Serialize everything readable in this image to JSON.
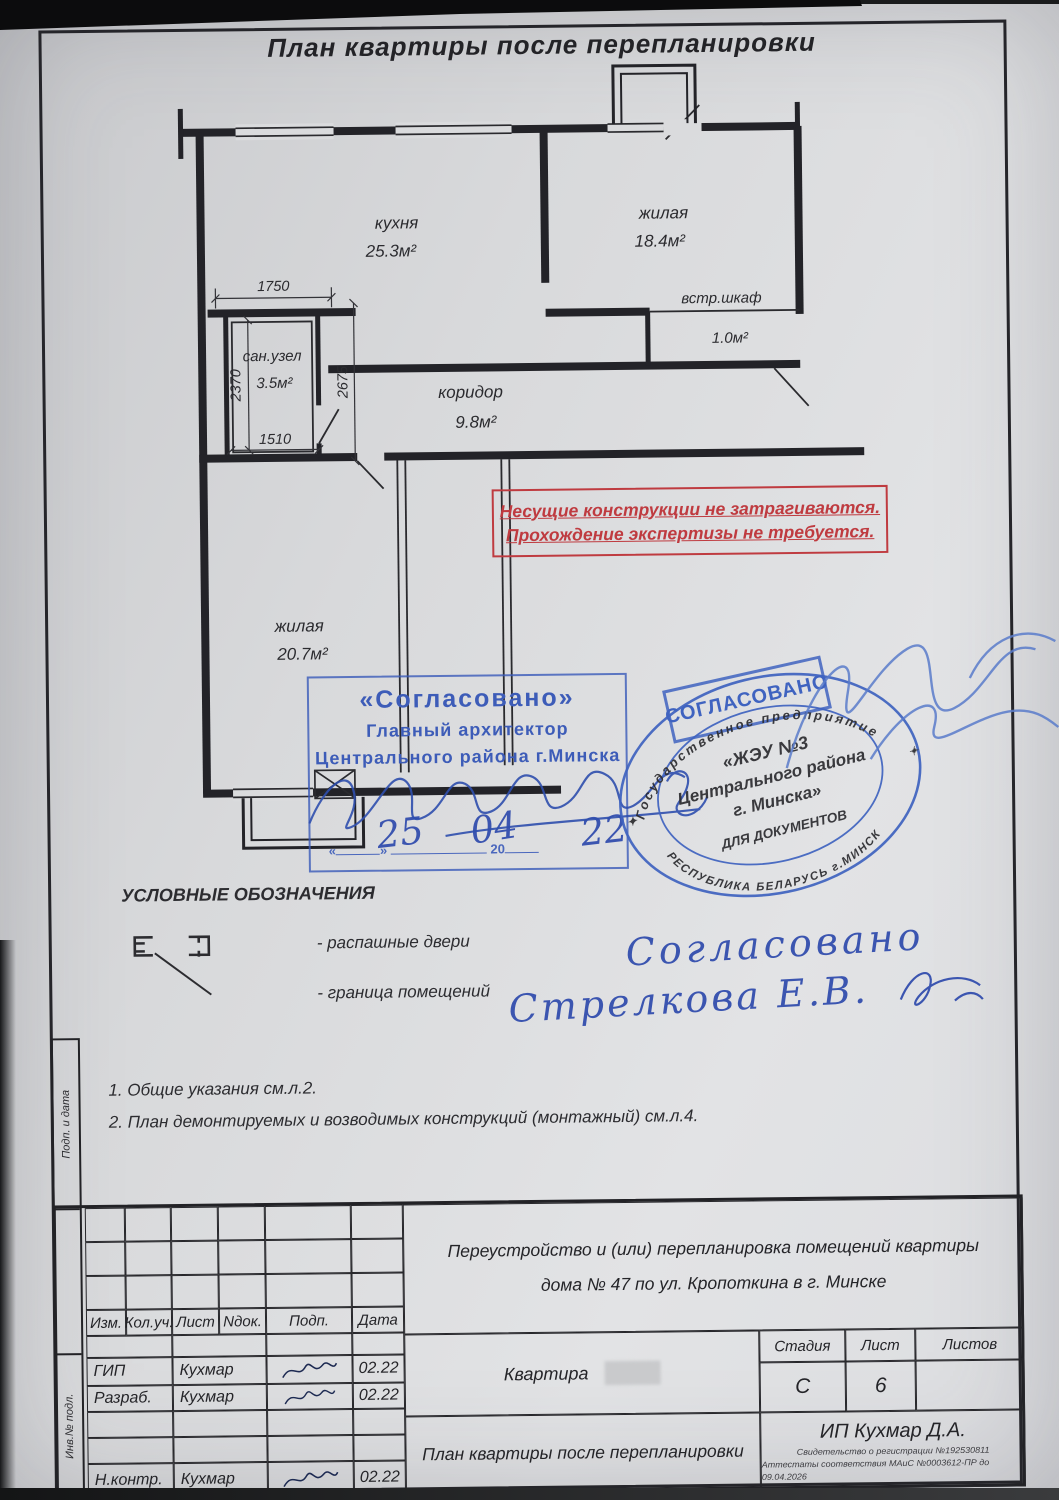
{
  "page_title": "План квартиры после перепланировки",
  "plan": {
    "rooms": {
      "kitchen": {
        "name": "кухня",
        "area": "25.3м²"
      },
      "living1": {
        "name": "жилая",
        "area": "18.4м²"
      },
      "closet": {
        "name": "встр.шкаф",
        "area": "1.0м²"
      },
      "corridor": {
        "name": "коридор",
        "area": "9.8м²"
      },
      "bathroom": {
        "name": "сан.узел",
        "area": "3.5м²"
      },
      "living2": {
        "name": "жилая",
        "area": "20.7м²"
      }
    },
    "dimensions": {
      "d1750": "1750",
      "d2370": "2370",
      "d1510": "1510",
      "d2675": "2675"
    }
  },
  "red_stamp": {
    "line1": "Несущие конструкции не затрагиваются.",
    "line2": "Прохождение экспертизы не требуется.",
    "color": "#bf3b40"
  },
  "approval_stamp": {
    "title": "«Согласовано»",
    "line1": "Главный архитектор",
    "line2": "Центрального района г.Минска",
    "quote_open": "«",
    "quote_close": "»",
    "year_prefix": "20",
    "date_day": "25",
    "date_month": "04",
    "date_year": "22",
    "color": "#3d5cb8"
  },
  "round_stamp": {
    "banner": "СОГЛАСОВАНО",
    "arc_top": "Государственное предприятие",
    "center_line1": "«ЖЭУ №3",
    "center_line2": "Центрального района",
    "center_line3": "г. Минска»",
    "center_line4": "ДЛЯ ДОКУМЕНТОВ",
    "arc_bottom": "РЕСПУБЛИКА БЕЛАРУСЬ г.МИНСК",
    "star": "✦",
    "color": "#3f63c0"
  },
  "handwriting": {
    "word1": "Согласовано",
    "word2": "Стрелкова Е.В.",
    "color": "#3b55b0"
  },
  "legend": {
    "title": "УСЛОВНЫЕ ОБОЗНАЧЕНИЯ",
    "item1": "- распашные двери",
    "item2": "- граница помещений"
  },
  "notes": {
    "n1": "1. Общие указания см.л.2.",
    "n2": "2. План демонтируемых и возводимых конструкций (монтажный) см.л.4."
  },
  "title_block": {
    "col_headers": {
      "c1": "Изм.",
      "c2": "Кол.уч.",
      "c3": "Лист",
      "c4": "Nдок.",
      "c5": "Подп.",
      "c6": "Дата"
    },
    "rows": {
      "r1": {
        "role": "ГИП",
        "name": "Кухмар",
        "date": "02.22"
      },
      "r2": {
        "role": "Разраб.",
        "name": "Кухмар",
        "date": "02.22"
      },
      "r3": {
        "role": "Н.контр.",
        "name": "Кухмар",
        "date": "02.22"
      }
    },
    "project_line1": "Переустройство и (или) перепланировка помещений квартиры",
    "project_line2": "дома № 47 по ул. Кропоткина в г. Минске",
    "object_label": "Квартира",
    "stage_label": "Стадия",
    "stage_value": "С",
    "sheet_label": "Лист",
    "sheet_value": "6",
    "sheets_label": "Листов",
    "sheets_value": "",
    "drawing_title": "План квартиры после перепланировки",
    "company": "ИП Кухмар Д.А.",
    "cert_line1": "Свидетельство о регистрации №192530811",
    "cert_line2": "Аттестаты соответствия МАиС №0003612-ПР до 09.04.2026"
  },
  "side_labels": {
    "s1": "Подп. и дата",
    "s2": "Инв.№ подл."
  }
}
